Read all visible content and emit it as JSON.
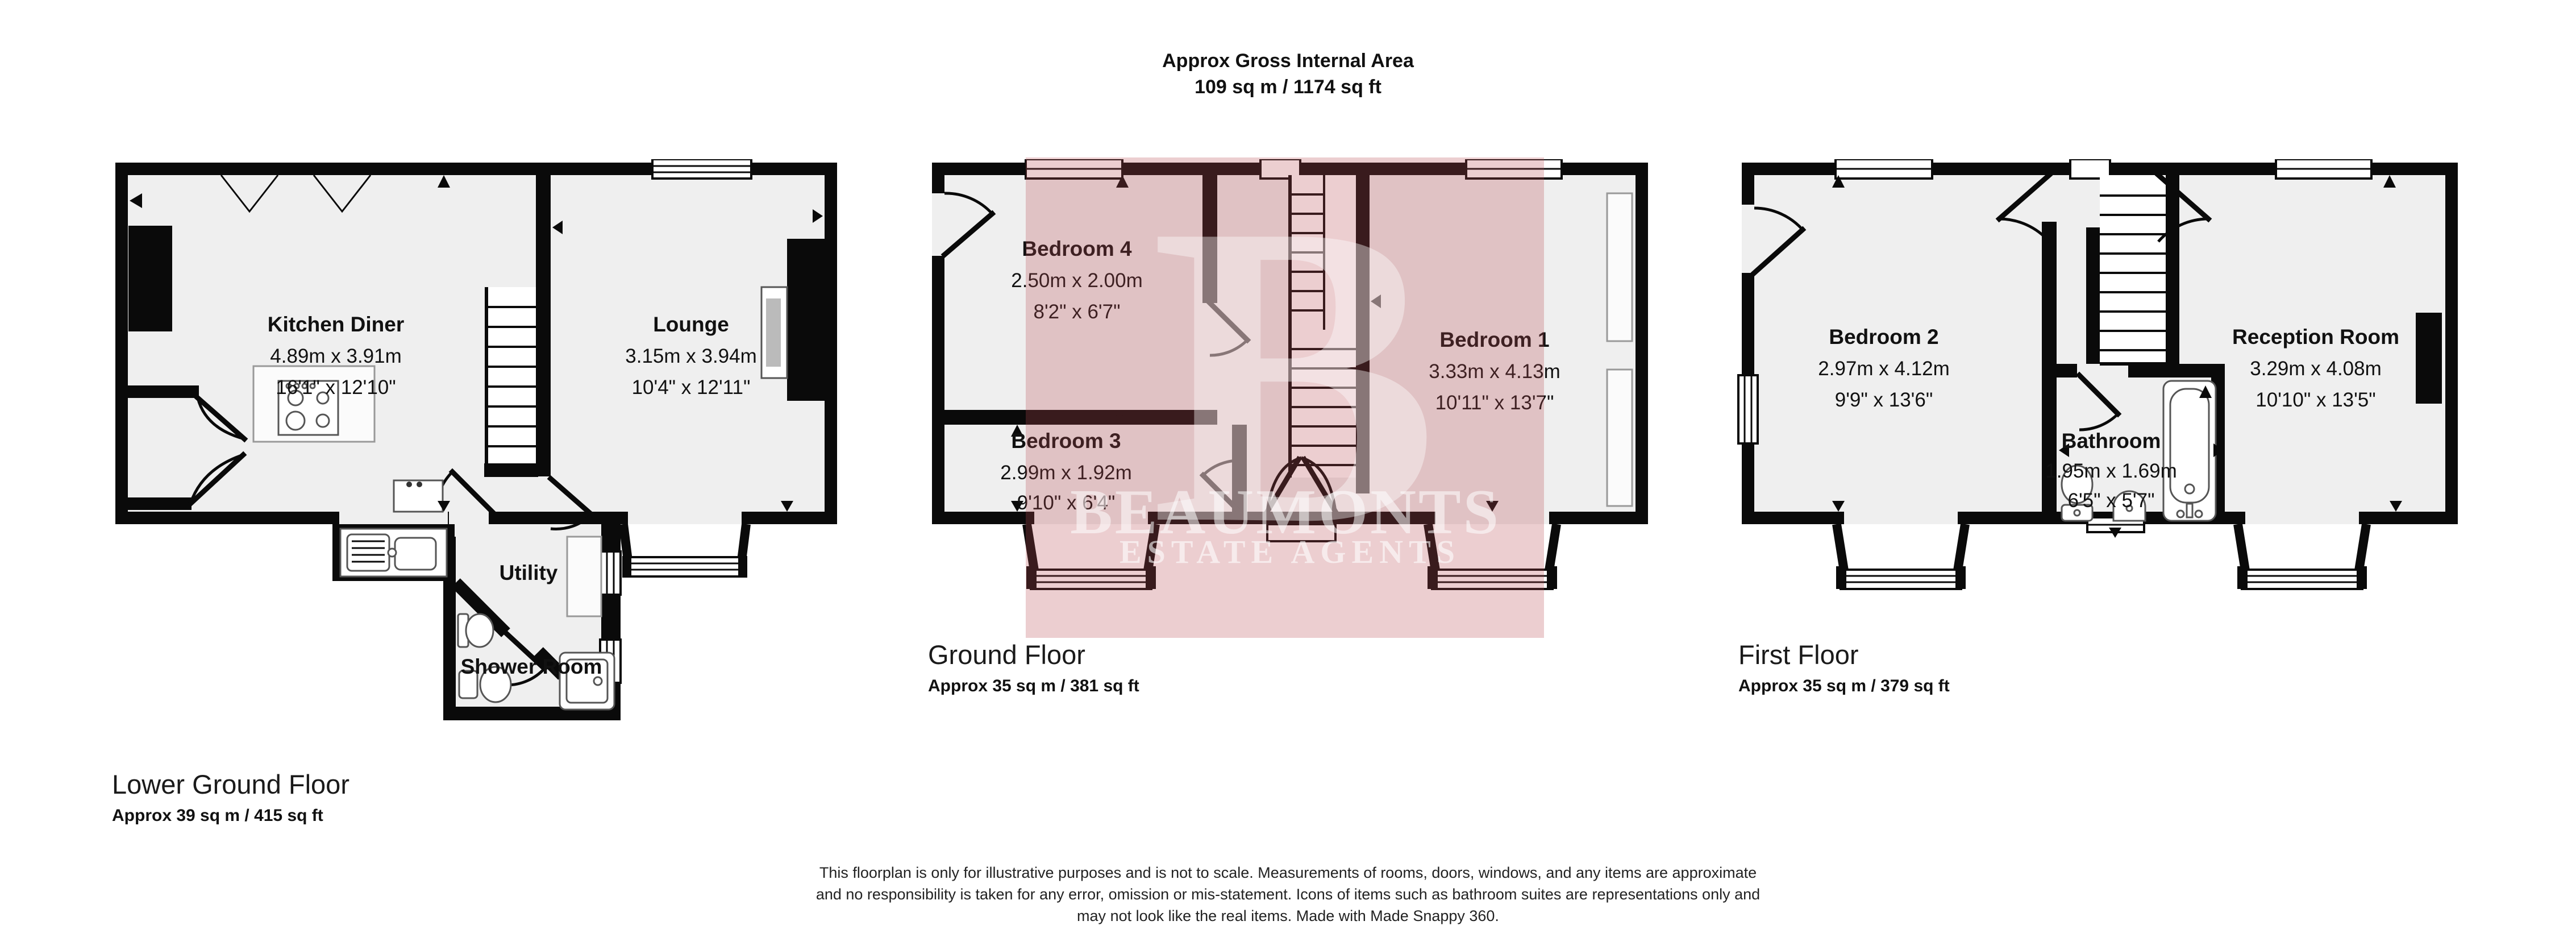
{
  "header": {
    "line1": "Approx Gross Internal Area",
    "line2": "109 sq m / 1174 sq ft"
  },
  "floors": [
    {
      "title": "Lower Ground Floor",
      "area": "Approx 39 sq m / 415 sq ft",
      "rooms": [
        {
          "name": "Kitchen Diner",
          "metric": "4.89m x 3.91m",
          "imperial": "16'1\" x 12'10\""
        },
        {
          "name": "Lounge",
          "metric": "3.15m x 3.94m",
          "imperial": "10'4\" x 12'11\""
        },
        {
          "name": "Utility",
          "metric": "",
          "imperial": ""
        },
        {
          "name": "Shower Room",
          "metric": "",
          "imperial": ""
        }
      ]
    },
    {
      "title": "Ground Floor",
      "area": "Approx 35 sq m / 381 sq ft",
      "rooms": [
        {
          "name": "Bedroom 4",
          "metric": "2.50m x 2.00m",
          "imperial": "8'2\" x 6'7\""
        },
        {
          "name": "Bedroom 3",
          "metric": "2.99m x 1.92m",
          "imperial": "9'10\" x 6'4\""
        },
        {
          "name": "Bedroom 1",
          "metric": "3.33m x 4.13m",
          "imperial": "10'11\" x 13'7\""
        }
      ]
    },
    {
      "title": "First Floor",
      "area": "Approx 35 sq m / 379 sq ft",
      "rooms": [
        {
          "name": "Bedroom 2",
          "metric": "2.97m x 4.12m",
          "imperial": "9'9\" x 13'6\""
        },
        {
          "name": "Bathroom",
          "metric": "1.95m x 1.69m",
          "imperial": "6'5\" x 5'7\""
        },
        {
          "name": "Reception Room",
          "metric": "3.29m x 4.08m",
          "imperial": "10'10\" x 13'5\""
        }
      ]
    }
  ],
  "watermark": {
    "initial": "B",
    "name": "BEAUMONTS",
    "tagline": "ESTATE AGENTS",
    "overlay_color": "#b94b50",
    "letter_color": "#ffffff"
  },
  "disclaimer": {
    "line1": "This floorplan is only for illustrative purposes and is not to scale. Measurements of rooms, doors, windows, and any items are approximate",
    "line2": "and no responsibility is taken for any error, omission or mis-statement. Icons of items such as bathroom suites are representations only and",
    "line3": "may not look like the real items. Made with Made Snappy 360."
  },
  "colors": {
    "wall": "#0a0a0a",
    "room_fill": "#efefef",
    "background": "#ffffff"
  }
}
